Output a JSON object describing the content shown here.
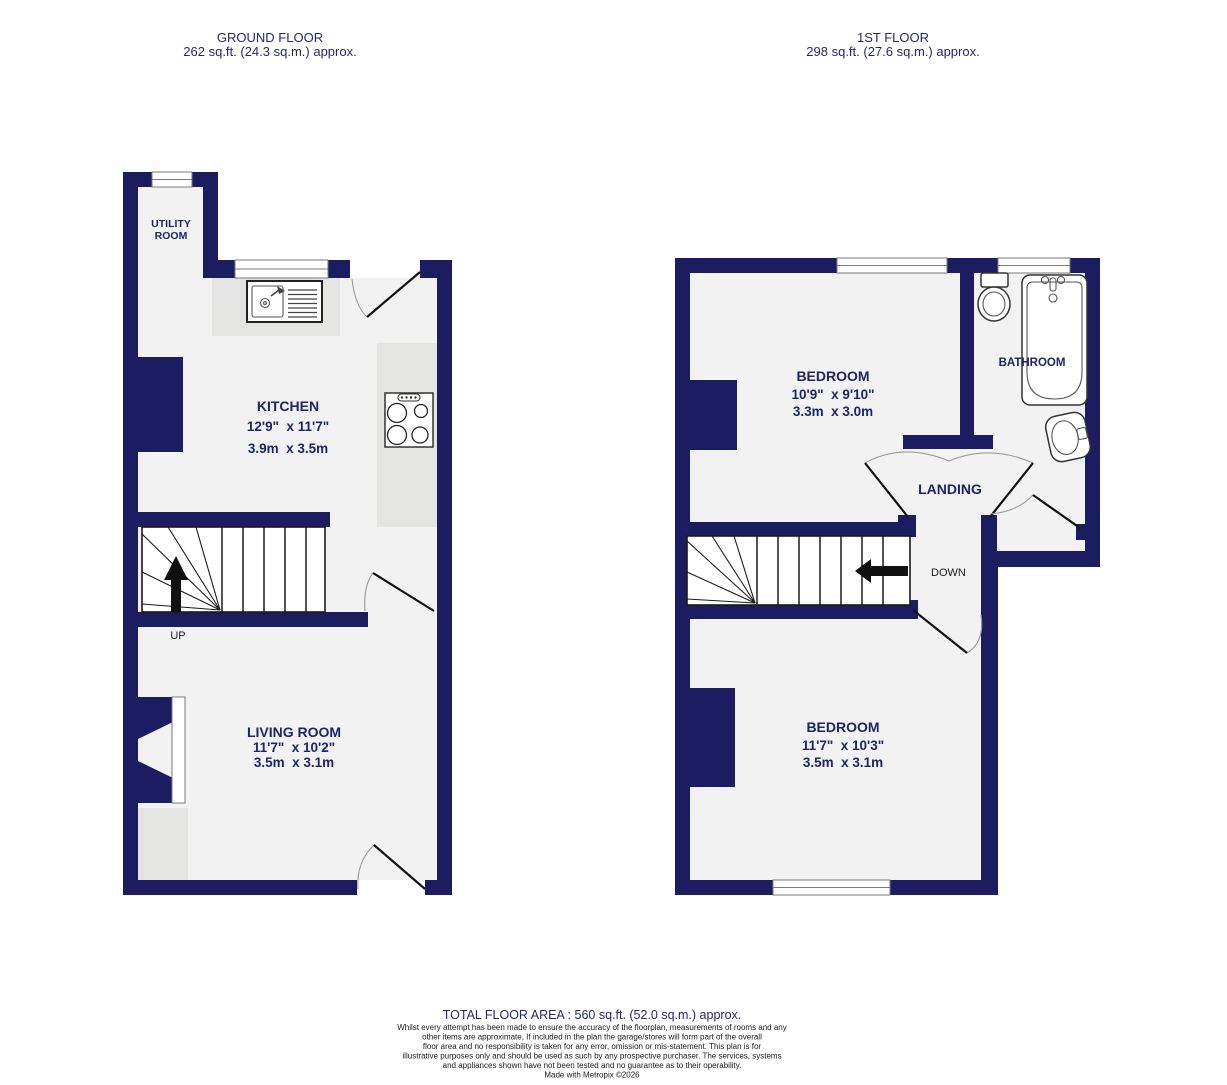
{
  "colors": {
    "wall": "#1c1c60",
    "floor": "#f2f2f2",
    "counter_gray": "#e4e4e3",
    "label_navy": "#1f2469",
    "door_leaf": "#111111",
    "swing_arc": "#9a9a9a"
  },
  "headers": {
    "ground": {
      "title": "GROUND FLOOR",
      "area": "262 sq.ft. (24.3 sq.m.) approx."
    },
    "first": {
      "title": "1ST FLOOR",
      "area": "298 sq.ft. (27.6 sq.m.) approx."
    }
  },
  "rooms": {
    "utility": {
      "name_line1": "UTILITY",
      "name_line2": "ROOM"
    },
    "kitchen": {
      "name": "KITCHEN",
      "imperial": "12'9\"  x 11'7\"",
      "metric": "3.9m  x 3.5m"
    },
    "living": {
      "name": "LIVING ROOM",
      "imperial": "11'7\"  x 10'2\"",
      "metric": "3.5m  x 3.1m"
    },
    "bedroom1": {
      "name": "BEDROOM",
      "imperial": "10'9\"  x 9'10\"",
      "metric": "3.3m  x 3.0m"
    },
    "bedroom2": {
      "name": "BEDROOM",
      "imperial": "11'7\"  x 10'3\"",
      "metric": "3.5m  x 3.1m"
    },
    "bathroom": {
      "name": "BATHROOM"
    },
    "landing": {
      "name": "LANDING"
    }
  },
  "stairs": {
    "up": "UP",
    "down": "DOWN"
  },
  "footer": {
    "total": "TOTAL FLOOR AREA : 560 sq.ft. (52.0 sq.m.) approx.",
    "disclaimer": [
      "Whilst every attempt has been made to ensure the accuracy of the floorplan, measurements of rooms and any",
      "other items are approximate, If included in the plan the garage/stores will form part of the overall",
      "floor area and no responsibility is taken for any error, omission or mis-statement. This plan is for",
      "illustrative purposes only and should be used as such by any prospective purchaser. The services, systems",
      "and appliances shown have not been tested and no guarantee as to their operability.",
      "Made with Metropix ©2026"
    ]
  }
}
